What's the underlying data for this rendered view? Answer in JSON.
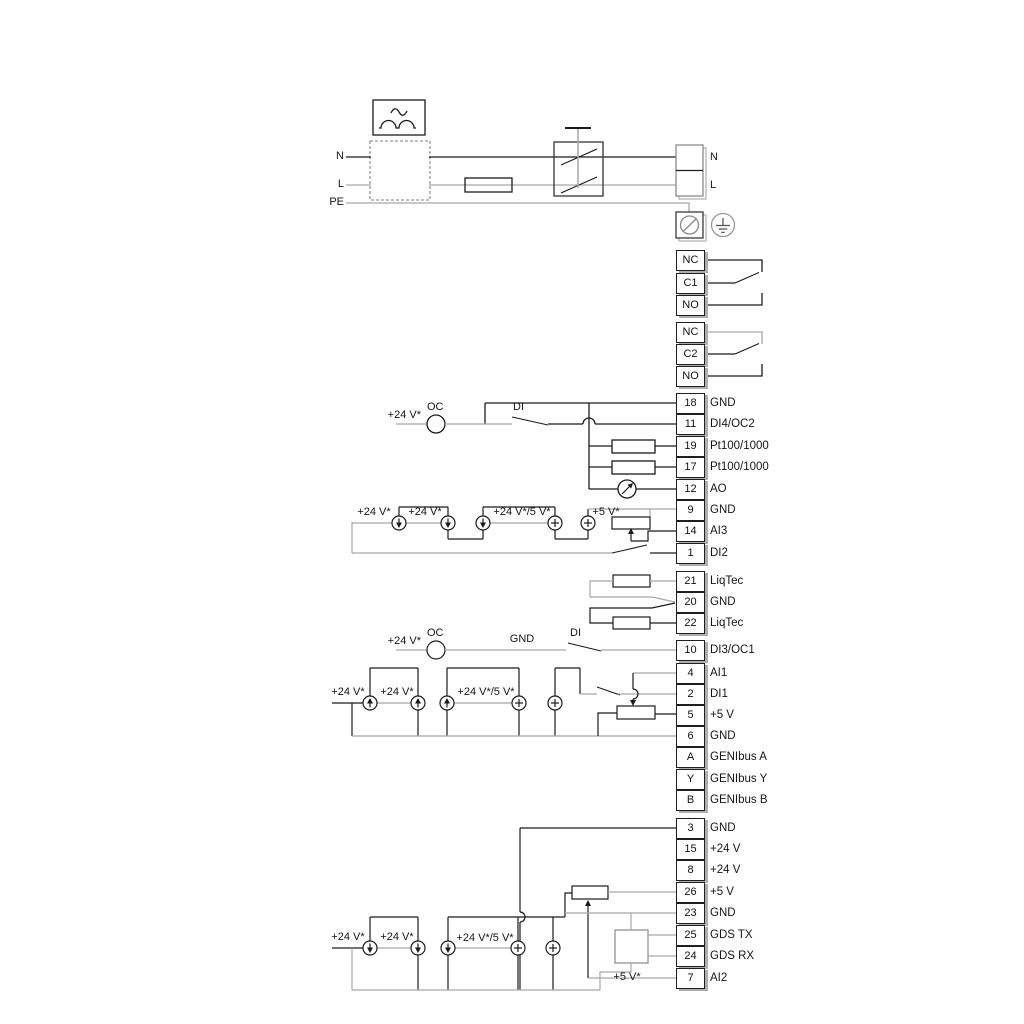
{
  "labels": {
    "n": "N",
    "l": "L",
    "pe": "PE",
    "n_term": "N",
    "l_term": "L",
    "oc": "OC",
    "di": "DI",
    "gnd_wire": "GND",
    "v24": "+24 V*",
    "v24_5": "+24 V*/5 V*",
    "v5": "+5 V*"
  },
  "colors": {
    "wire_black": "#1b1b1b",
    "wire_gray": "#a8a8a8",
    "box_border": "#1f1f1f",
    "box_shadow": "#aeaeae"
  },
  "terminals": {
    "relay1": {
      "rows": [
        {
          "id": "NC"
        },
        {
          "id": "C1"
        },
        {
          "id": "NO"
        }
      ]
    },
    "relay2": {
      "rows": [
        {
          "id": "NC"
        },
        {
          "id": "C2"
        },
        {
          "id": "NO"
        }
      ]
    },
    "io1": {
      "rows": [
        {
          "id": "18",
          "label": "GND"
        },
        {
          "id": "11",
          "label": "DI4/OC2"
        },
        {
          "id": "19",
          "label": "Pt100/1000"
        },
        {
          "id": "17",
          "label": "Pt100/1000"
        },
        {
          "id": "12",
          "label": "AO"
        },
        {
          "id": "9",
          "label": "GND"
        },
        {
          "id": "14",
          "label": "AI3"
        },
        {
          "id": "1",
          "label": "DI2"
        }
      ]
    },
    "liqtec": {
      "rows": [
        {
          "id": "21",
          "label": "LiqTec"
        },
        {
          "id": "20",
          "label": "GND"
        },
        {
          "id": "22",
          "label": "LiqTec"
        }
      ]
    },
    "io2": {
      "rows": [
        {
          "id": "10",
          "label": "DI3/OC1"
        },
        {
          "id": "4",
          "label": "AI1"
        },
        {
          "id": "2",
          "label": "DI1"
        },
        {
          "id": "5",
          "label": "+5 V"
        },
        {
          "id": "6",
          "label": "GND"
        },
        {
          "id": "A",
          "label": "GENIbus A"
        },
        {
          "id": "Y",
          "label": "GENIbus Y"
        },
        {
          "id": "B",
          "label": "GENIbus B"
        }
      ]
    },
    "io3": {
      "rows": [
        {
          "id": "3",
          "label": "GND"
        },
        {
          "id": "15",
          "label": "+24 V"
        },
        {
          "id": "8",
          "label": "+24 V"
        },
        {
          "id": "26",
          "label": "+5 V"
        },
        {
          "id": "23",
          "label": "GND"
        },
        {
          "id": "25",
          "label": "GDS TX"
        },
        {
          "id": "24",
          "label": "GDS RX"
        },
        {
          "id": "7",
          "label": "AI2"
        }
      ]
    }
  }
}
